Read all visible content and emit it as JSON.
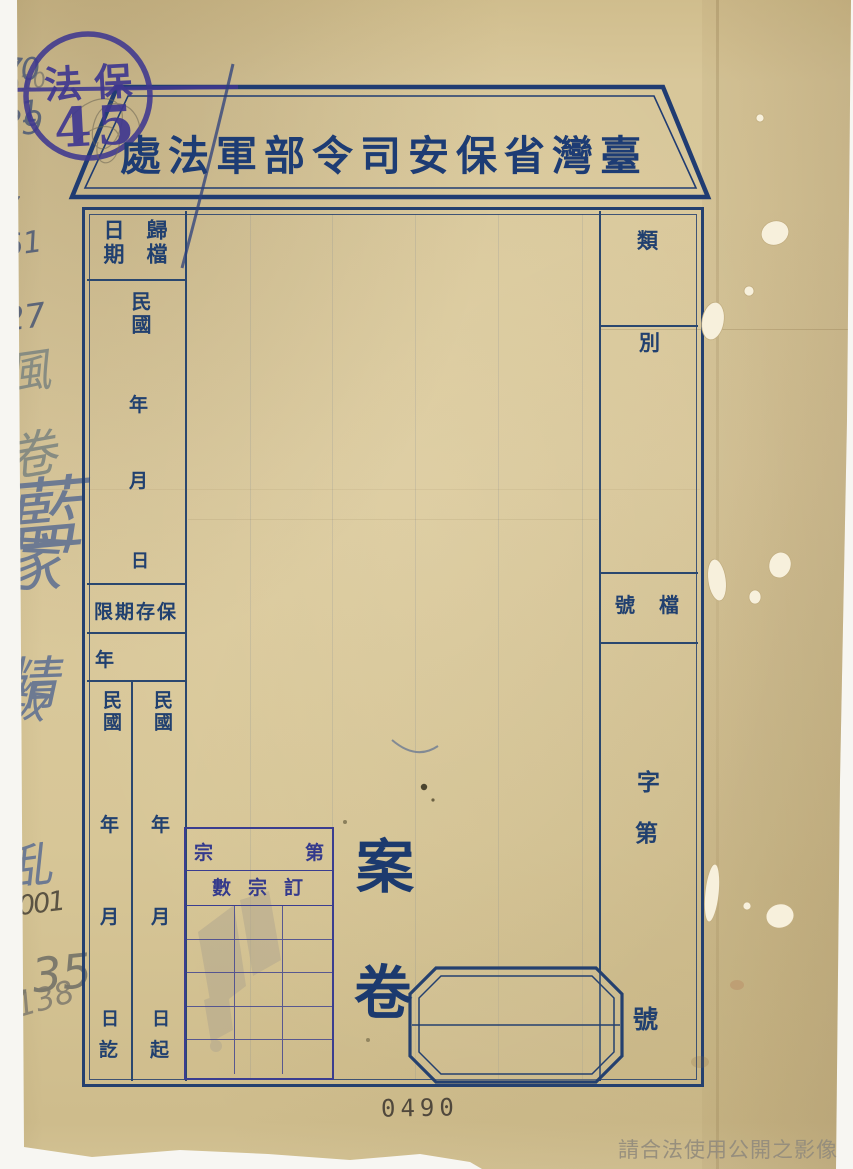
{
  "page": {
    "stamp": {
      "text_top": "法保",
      "text_number": "45"
    },
    "pencil_annotations": {
      "top": "010",
      "bottom_left": "138",
      "bottom_right": "135",
      "handwritten_serial": "0001"
    },
    "banner_title": "處法軍部令司安保省灣臺",
    "filing_date": {
      "header_right": "歸檔",
      "header_left": "日期",
      "era": "民國",
      "year_label": "年",
      "month_label": "月",
      "day_label": "日"
    },
    "retention": {
      "header": "限期存保",
      "year_label": "年",
      "value": "20"
    },
    "date_start": {
      "era": "民國",
      "year_value": "41",
      "year_label": "年",
      "month_value": "7",
      "month_label": "月",
      "day_value": "29",
      "day_label": "日",
      "suffix": "起"
    },
    "date_end": {
      "era": "民國",
      "year_value": "61",
      "year_label": "年",
      "month_value": "7",
      "month_label": "月",
      "day_value": "27",
      "day_label": "日",
      "suffix": "訖"
    },
    "category": {
      "header_top": "類",
      "header_bottom": "別",
      "value": "風卷",
      "value_char1": "風",
      "value_char2": "卷"
    },
    "file_number": {
      "header_right": "檔",
      "header_left": "號",
      "zi": "字",
      "di": "第",
      "hao": "號"
    },
    "case": {
      "title_full": "藍家精叛亂",
      "title_chars": [
        "藍",
        "家",
        "精",
        "叛",
        "乱"
      ],
      "label_top": "案",
      "label_bottom": "卷"
    },
    "mini_table": {
      "row1_left": "宗",
      "row1_right": "第",
      "row2": "數宗訂續"
    },
    "stamp_number": "0490",
    "watermark": "請合法使用公開之影像",
    "colors": {
      "ink_navy": "#21406f",
      "stamp_purple": "#3f3890",
      "table_indigo": "#3a3d90",
      "pencil_grey": "#8b8472",
      "paper": "#d8c79a"
    }
  }
}
